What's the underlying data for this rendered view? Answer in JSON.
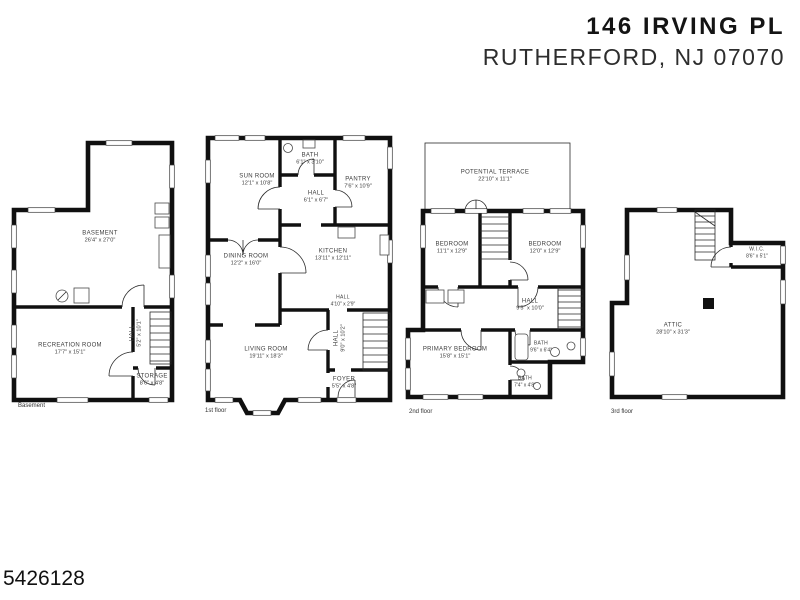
{
  "header": {
    "title": "146 IRVING PL",
    "subtitle": "RUTHERFORD, NJ 07070"
  },
  "footer": {
    "listing_id": "5426128"
  },
  "floors": [
    {
      "caption": "Basement",
      "rooms": [
        {
          "name": "BASEMENT",
          "dims": "26'4\" x 27'0\""
        },
        {
          "name": "RECREATION ROOM",
          "dims": "17'7\" x 15'1\""
        },
        {
          "name": "HALL",
          "dims": "5'2\" x 10'1\""
        },
        {
          "name": "STORAGE",
          "dims": "8'6\" x 4'8\""
        }
      ]
    },
    {
      "caption": "1st floor",
      "rooms": [
        {
          "name": "SUN ROOM",
          "dims": "12'1\" x 10'8\""
        },
        {
          "name": "BATH",
          "dims": "6'1\" x 3'10\""
        },
        {
          "name": "HALL",
          "dims": "6'1\" x 6'7\""
        },
        {
          "name": "PANTRY",
          "dims": "7'6\" x 10'9\""
        },
        {
          "name": "DINING ROOM",
          "dims": "12'2\" x 16'0\""
        },
        {
          "name": "KITCHEN",
          "dims": "13'11\" x 12'11\""
        },
        {
          "name": "HALL",
          "dims": "4'10\" x 2'9\""
        },
        {
          "name": "HALL",
          "dims": "9'0\" x 10'2\""
        },
        {
          "name": "LIVING ROOM",
          "dims": "19'11\" x 18'3\""
        },
        {
          "name": "FOYER",
          "dims": "5'5\" x 4'8\""
        }
      ]
    },
    {
      "caption": "2nd floor",
      "rooms": [
        {
          "name": "POTENTIAL TERRACE",
          "dims": "22'10\" x 11'1\""
        },
        {
          "name": "BEDROOM",
          "dims": "11'1\" x 12'9\""
        },
        {
          "name": "BEDROOM",
          "dims": "12'0\" x 12'9\""
        },
        {
          "name": "HALL",
          "dims": "9'5\" x 10'0\""
        },
        {
          "name": "PRIMARY BEDROOM",
          "dims": "15'8\" x 15'1\""
        },
        {
          "name": "BATH",
          "dims": "9'6\" x 6'4\""
        },
        {
          "name": "BATH",
          "dims": "7'4\" x 4'8\""
        }
      ]
    },
    {
      "caption": "3rd floor",
      "rooms": [
        {
          "name": "ATTIC",
          "dims": "28'10\" x 31'3\""
        },
        {
          "name": "W.I.C.",
          "dims": "8'6\" x 5'1\""
        }
      ]
    }
  ]
}
